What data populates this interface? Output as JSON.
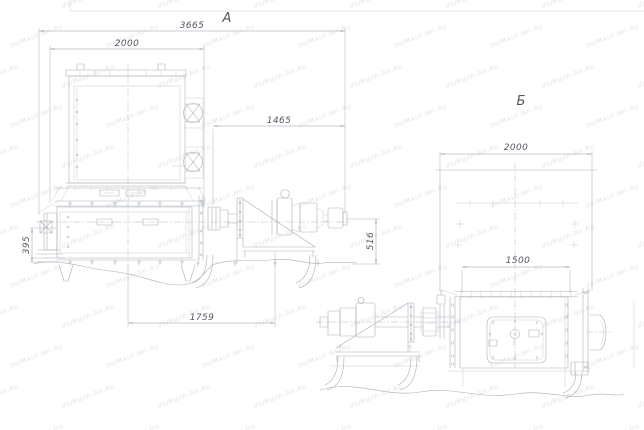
{
  "watermark": {
    "text": "VolMash-Nn.Ru"
  },
  "colors": {
    "background": "#ffffff",
    "line": "#aab0b8",
    "line_light": "#c9cdd3",
    "dimension": "#989ea7",
    "text": "#52575f",
    "watermark": "#d6dade"
  },
  "drawing": {
    "views": {
      "a": {
        "label": "А",
        "dims": {
          "overall_length": "3665",
          "body_width": "2000",
          "drive_length": "1465",
          "left_height": "395",
          "right_height": "516",
          "base_span": "1759"
        }
      },
      "b": {
        "label": "Б",
        "dims": {
          "body_width": "2000",
          "flange_width": "1500"
        }
      }
    }
  }
}
